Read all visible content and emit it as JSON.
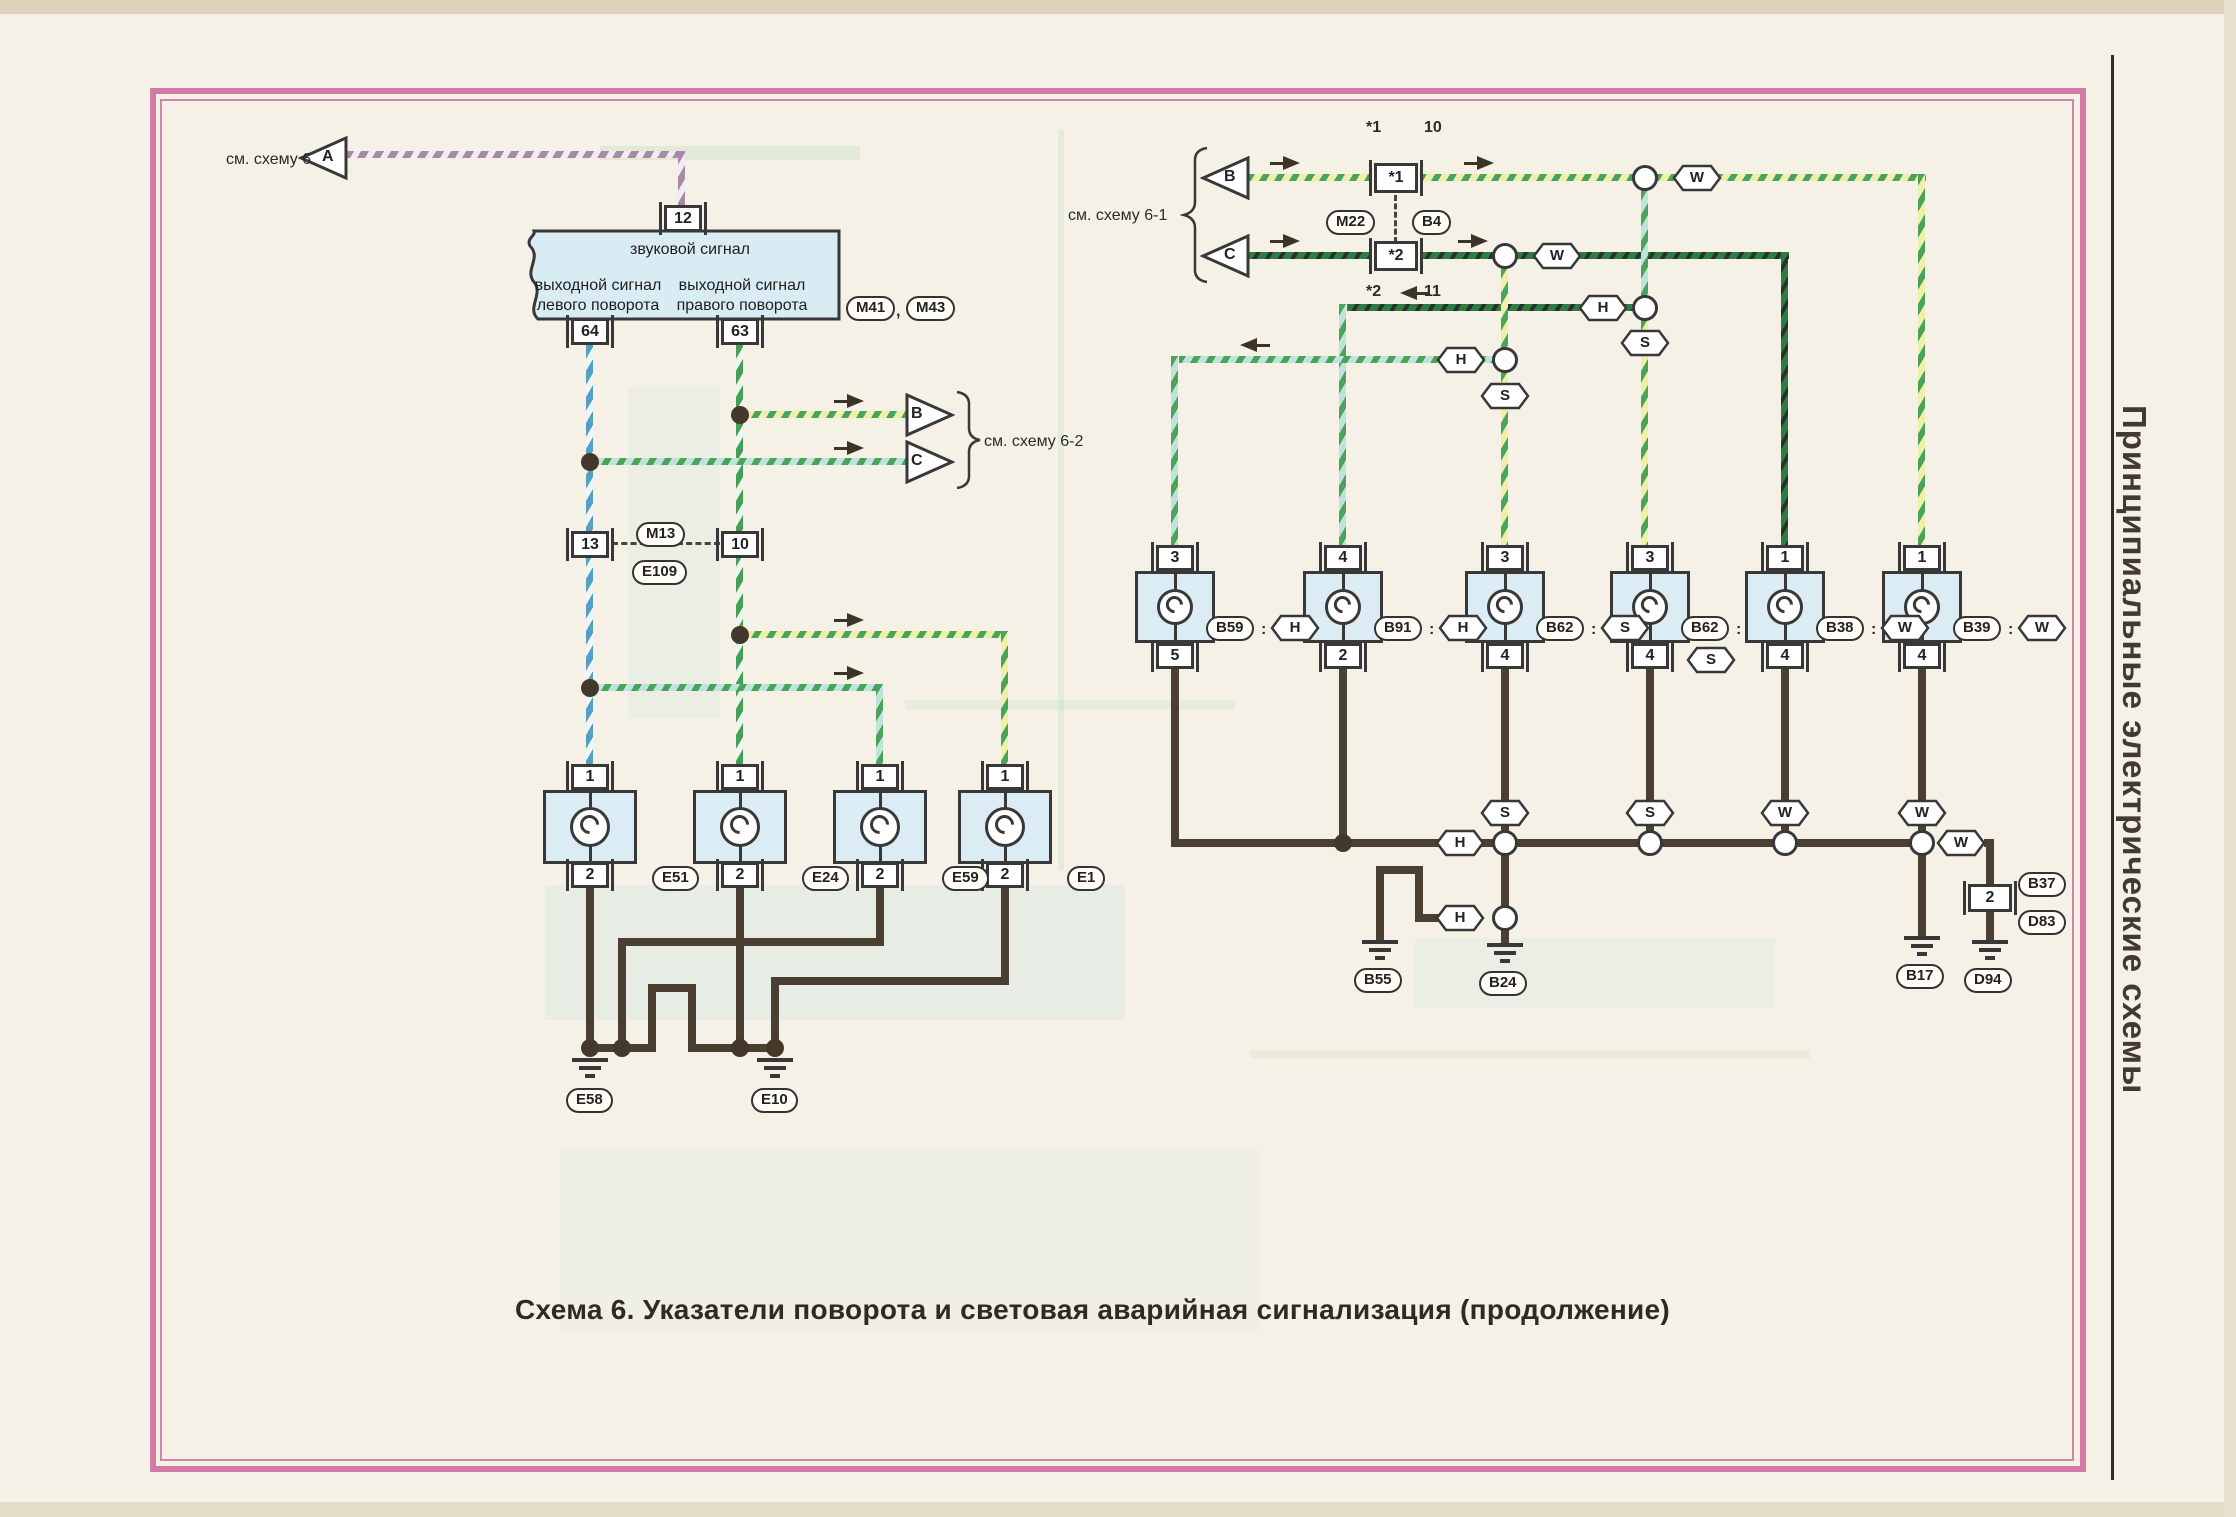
{
  "page": {
    "title": "Схема 6. Указатели поворота и световая аварийная сигнализация (продолжение)",
    "sidebar": "Принципиальные электрические схемы"
  },
  "codes": {
    "h": "H",
    "s": "S",
    "w": "W"
  },
  "punct": {
    "colon": ":",
    "comma": ","
  },
  "refs": {
    "see6": "см. схему 6",
    "see61": "см. схему 6-1",
    "see62": "см. схему 6-2",
    "a": "A",
    "b_out": "B",
    "c_out": "C",
    "b_in": "B",
    "c_in": "C"
  },
  "horn": {
    "title": "звуковой сигнал",
    "out_left1": "выходной сигнал",
    "out_left2": "левого поворота",
    "out_right1": "выходной сигнал",
    "out_right2": "правого поворота",
    "pin_top": "12",
    "pin_left": "64",
    "pin_right": "63",
    "id1": "M41",
    "id2": "M43"
  },
  "inline_conn": {
    "pin_l": "13",
    "pin_r": "10",
    "id_top": "M13",
    "id_bot": "E109"
  },
  "star_conn": {
    "pin1": "*1",
    "pin1_note_l": "*1",
    "pin1_note_r": "10",
    "pin2": "*2",
    "pin2_note_l": "*2",
    "pin2_note_r": "11",
    "id_l": "M22",
    "id_r": "B4"
  },
  "left_lamps": [
    {
      "top": "1",
      "bot": "2",
      "id": "E51"
    },
    {
      "top": "1",
      "bot": "2",
      "id": "E24"
    },
    {
      "top": "1",
      "bot": "2",
      "id": "E59"
    },
    {
      "top": "1",
      "bot": "2",
      "id": "E1"
    }
  ],
  "left_grounds": {
    "g1": "E58",
    "g2": "E10"
  },
  "right_lamps": [
    {
      "top": "3",
      "bot": "5",
      "id": "B59",
      "code": "H"
    },
    {
      "top": "4",
      "bot": "2",
      "id": "B91",
      "code": "H"
    },
    {
      "top": "3",
      "bot": "4",
      "id": "B62",
      "code": "S"
    },
    {
      "top": "3",
      "bot": "4",
      "id": "B62",
      "code": "S"
    },
    {
      "top": "1",
      "bot": "4",
      "id": "B38",
      "code": "W"
    },
    {
      "top": "1",
      "bot": "4",
      "id": "B39",
      "code": "W"
    }
  ],
  "right_grounds": {
    "g1": "B55",
    "g2": "B24",
    "g3": "B17",
    "g4": "D94"
  },
  "right_conn": {
    "pin": "2",
    "id_top": "B37",
    "id_bot": "D83"
  }
}
